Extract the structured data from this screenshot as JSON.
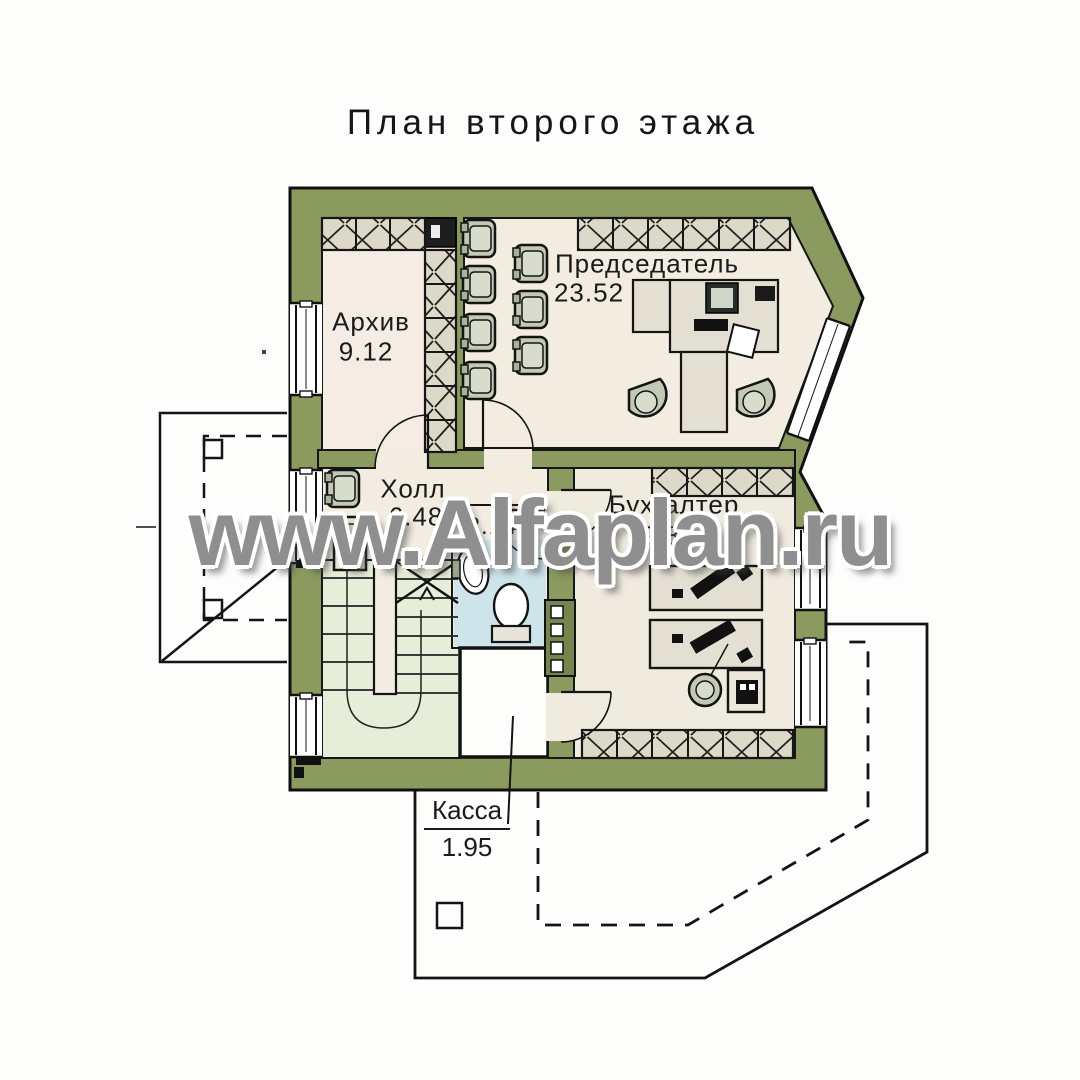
{
  "title": "План второго этажа",
  "watermark": "www.Alfaplan.ru",
  "rooms": {
    "archive": {
      "name": "Архив",
      "area": "9.12"
    },
    "chairman": {
      "name": "Председатель",
      "area": "23.52"
    },
    "hall": {
      "name": "Холл",
      "area": "6.48"
    },
    "bathroom": {
      "name": "",
      "area": "2.14"
    },
    "accountant": {
      "name": "Бухгалтер",
      "area": "19.84"
    },
    "cashier": {
      "name": "Касса",
      "area": "1.95"
    }
  },
  "colors": {
    "wall": "#8b9a5f",
    "wall_dark": "#76844d",
    "floor": "#f2ece1",
    "floor_archive": "#f5ece4",
    "floor_accountant": "#f0ebdf",
    "stairs": "#e6edd8",
    "bathroom": "#cde4ea",
    "hatch_bg": "#ddd9c8",
    "cashier_floor": "#fdfdfc",
    "outline": "#1a1a1a",
    "watermark": "#8f8f8f"
  }
}
